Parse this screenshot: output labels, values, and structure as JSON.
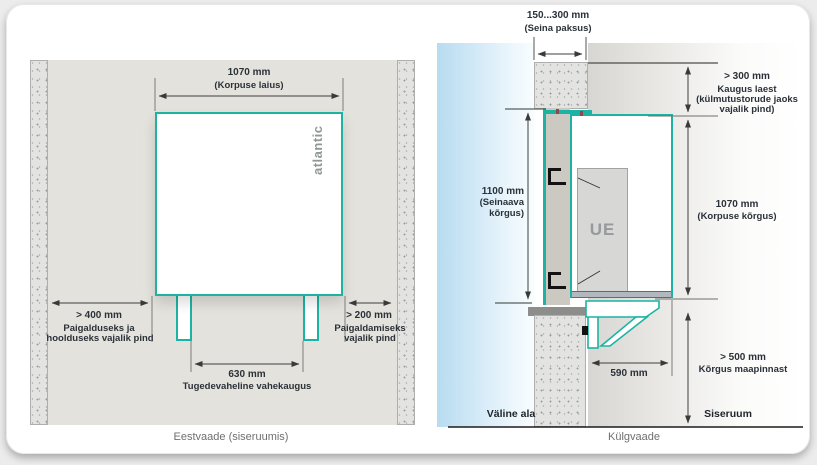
{
  "colors": {
    "accent_teal": "#1cb3a2",
    "outdoor_blue": "#b7dcf0",
    "wall_grey": "#e3e3e1"
  },
  "front": {
    "caption": "Eestvaade (siseruumis)",
    "brand": "atlantic",
    "dim_width": {
      "value": "1070 mm",
      "label": "(Korpuse laius)"
    },
    "dim_left": {
      "value": "> 400 mm",
      "label_line1": "Paigalduseks ja",
      "label_line2": "hoolduseks vajalik pind"
    },
    "dim_right": {
      "value": "> 200 mm",
      "label_line1": "Paigaldamiseks",
      "label_line2": "vajalik pind"
    },
    "dim_supports": {
      "value": "630 mm",
      "label": "Tugedevaheline vahekaugus"
    }
  },
  "side": {
    "caption": "Külgvaade",
    "unit_label": "UE",
    "dim_wall": {
      "value": "150...300 mm",
      "label": "(Seina paksus)"
    },
    "dim_ceiling": {
      "value": "> 300 mm",
      "label_line1": "Kaugus laest",
      "label_line2": "(külmutustorude jaoks",
      "label_line3": "vajalik pind)"
    },
    "dim_opening": {
      "value": "1100 mm",
      "label_line1": "(Seinaava",
      "label_line2": "kõrgus)"
    },
    "dim_body": {
      "value": "1070 mm",
      "label": "(Korpuse kõrgus)"
    },
    "dim_ground": {
      "value": "> 500 mm",
      "label": "Kõrgus maapinnast"
    },
    "dim_depth": {
      "value": "590 mm"
    },
    "outside_label": "Väline ala",
    "inside_label": "Siseruum"
  }
}
